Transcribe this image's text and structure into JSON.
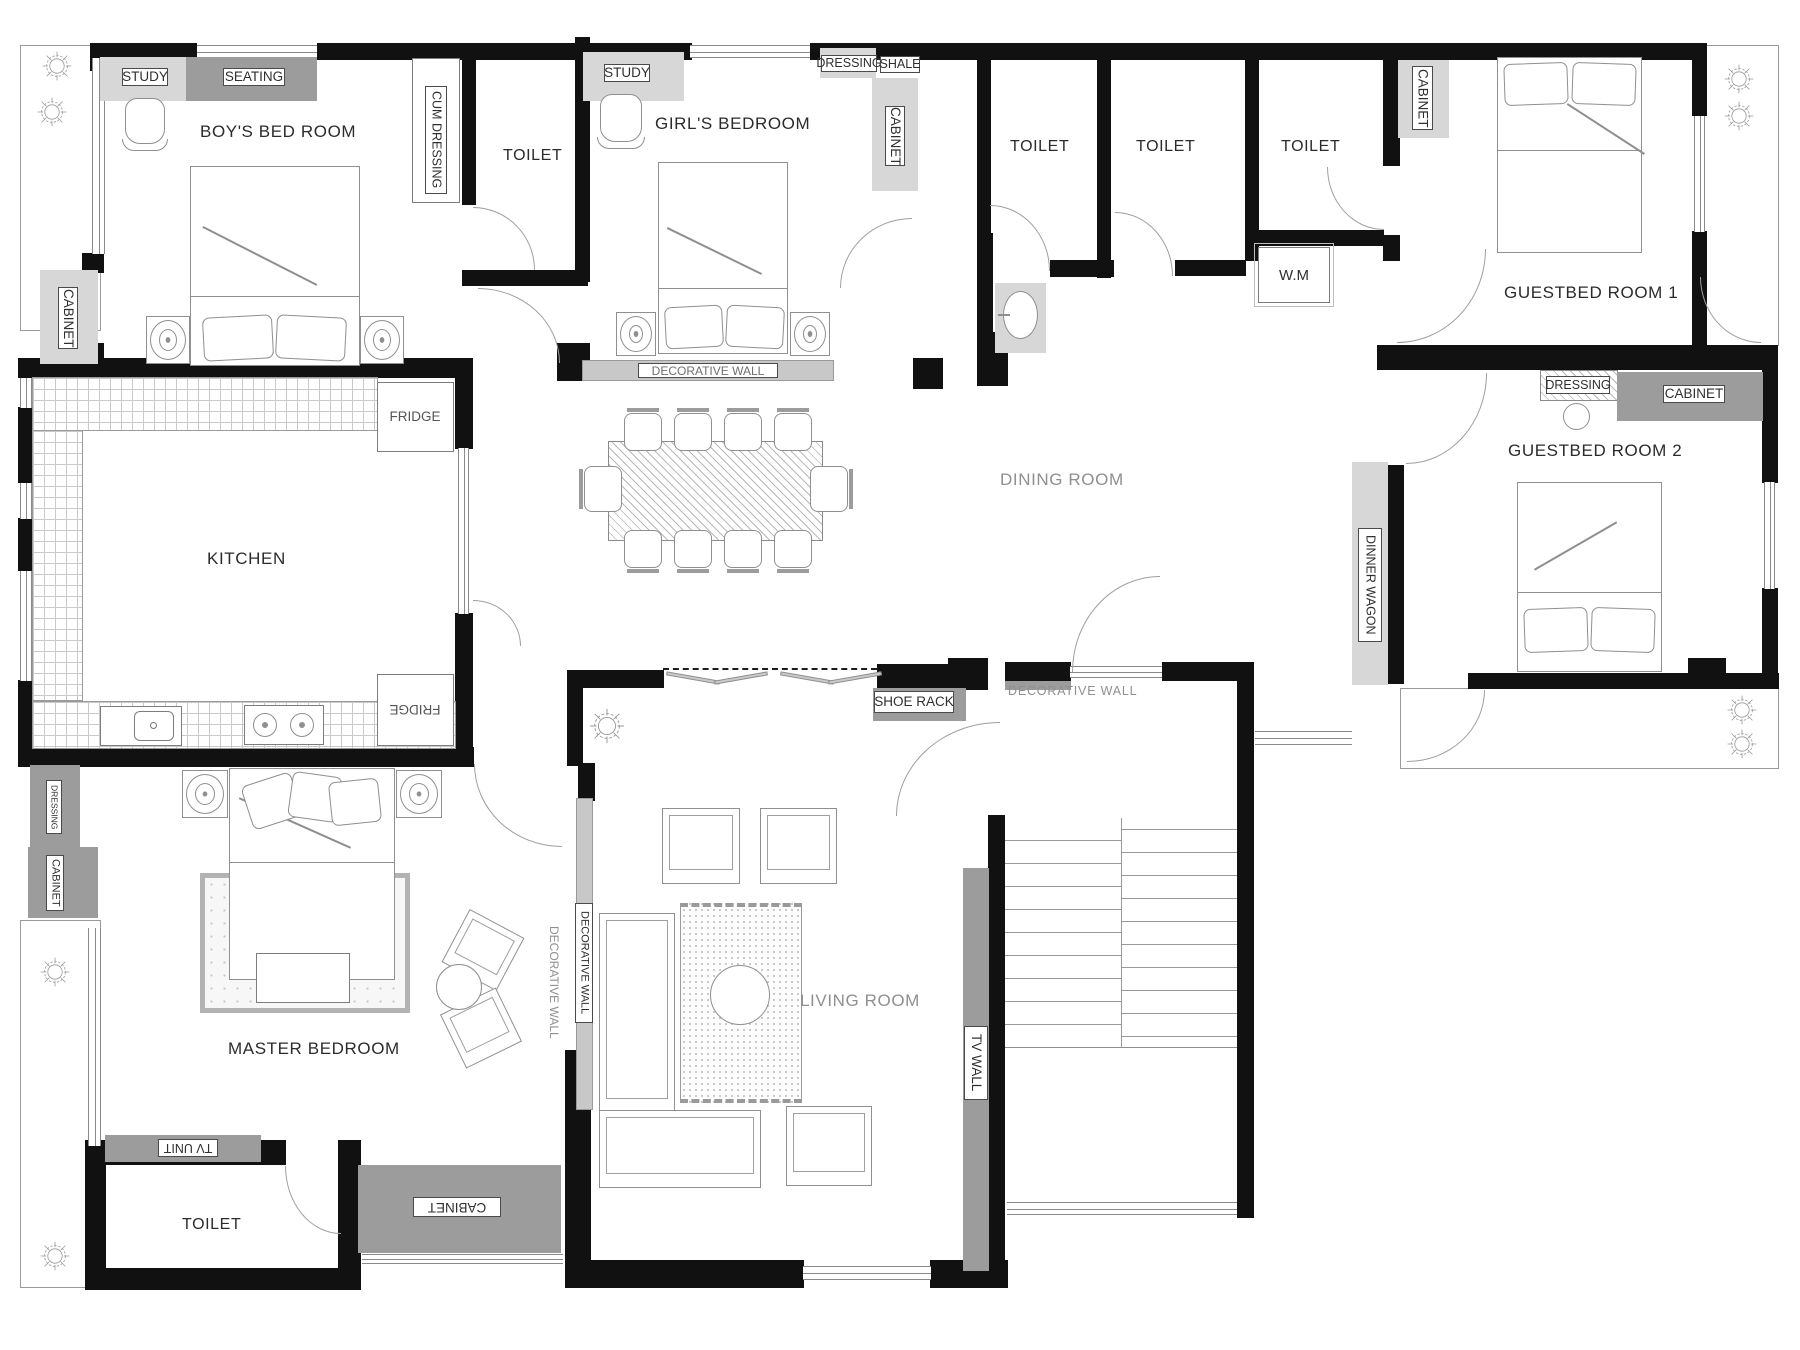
{
  "plan": {
    "title": "apartment-floor-plan",
    "rooms": {
      "boys_bedroom": "BOY'S BED ROOM",
      "girls_bedroom": "GIRL'S  BEDROOM",
      "toilet": "TOILET",
      "guestbed_room_1": "GUESTBED  ROOM 1",
      "guestbed_room_2": "GUESTBED  ROOM 2",
      "kitchen": "KITCHEN",
      "dining_room": "DINING ROOM",
      "master_bedroom": "MASTER BEDROOM",
      "living_room": "LIVING ROOM"
    },
    "features": {
      "study": "STUDY",
      "seating": "SEATING",
      "cum_dressing": "CUM DRESSING",
      "cabinet": "CABINET",
      "fridge": "FRIDGE",
      "dressing": "DRESSING",
      "shale": "SHALE",
      "wm": "W.M",
      "decorative_wall": "DECORATIVE WALL",
      "shoe_rack": "SHOE RACK",
      "dinner_wagon": "DINNER WAGON",
      "tv_wall": "TV WALL",
      "tv_unit": "TV UNIT"
    },
    "colors": {
      "wall": "#111111",
      "dark_band": "#9c9c9c",
      "light_band": "#d7d7d7",
      "furniture_line": "#8f8f8f",
      "text_dark": "#2b2b2b",
      "text_gray": "#8f8f8f"
    }
  }
}
